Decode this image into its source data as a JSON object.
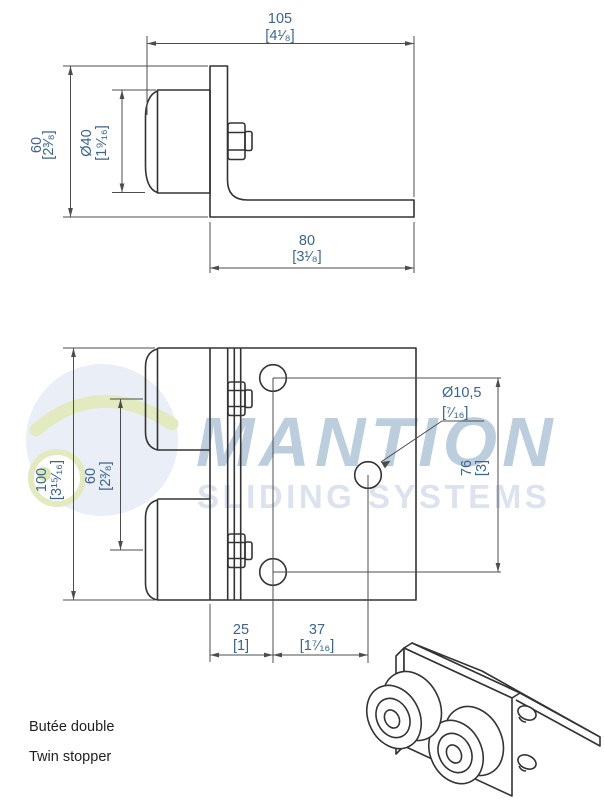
{
  "colors": {
    "dimension_text": "#3d648c",
    "drawing_line": "#333333",
    "dimension_line": "#4c4c4c",
    "caption_text": "#1f1f1f",
    "watermark_brand": "#bccede",
    "watermark_tagline": "#dce3ee",
    "watermark_logo_blue": "#e9eef7",
    "watermark_logo_green": "#e3eabf"
  },
  "captions": {
    "french": "Butée double",
    "english": "Twin stopper"
  },
  "watermark": {
    "brand": "MANTION",
    "tagline": "SLIDING SYSTEMS"
  },
  "side_view": {
    "dim_depth": {
      "mm": "105",
      "inch": "[4¹⁄₈]"
    },
    "dim_height": {
      "mm": "60",
      "inch": "[2³⁄₈]"
    },
    "dim_buffer": {
      "mm": "Ø40",
      "inch": "[1⁹⁄₁₆]"
    },
    "dim_leg": {
      "mm": "80",
      "inch": "[3¹⁄₈]"
    }
  },
  "plan_view": {
    "dim_width": {
      "mm": "100",
      "inch": "[3¹⁵⁄₁₆]"
    },
    "dim_spacing": {
      "mm": "60",
      "inch": "[2³⁄₈]"
    },
    "dim_hole": {
      "mm": "Ø10,5",
      "inch": "[⁷⁄₁₆]"
    },
    "dim_hole_span": {
      "mm": "76",
      "inch": "[3]"
    },
    "dim_offset1": {
      "mm": "25",
      "inch": "[1]"
    },
    "dim_offset2": {
      "mm": "37",
      "inch": "[1⁷⁄₁₆]"
    }
  }
}
